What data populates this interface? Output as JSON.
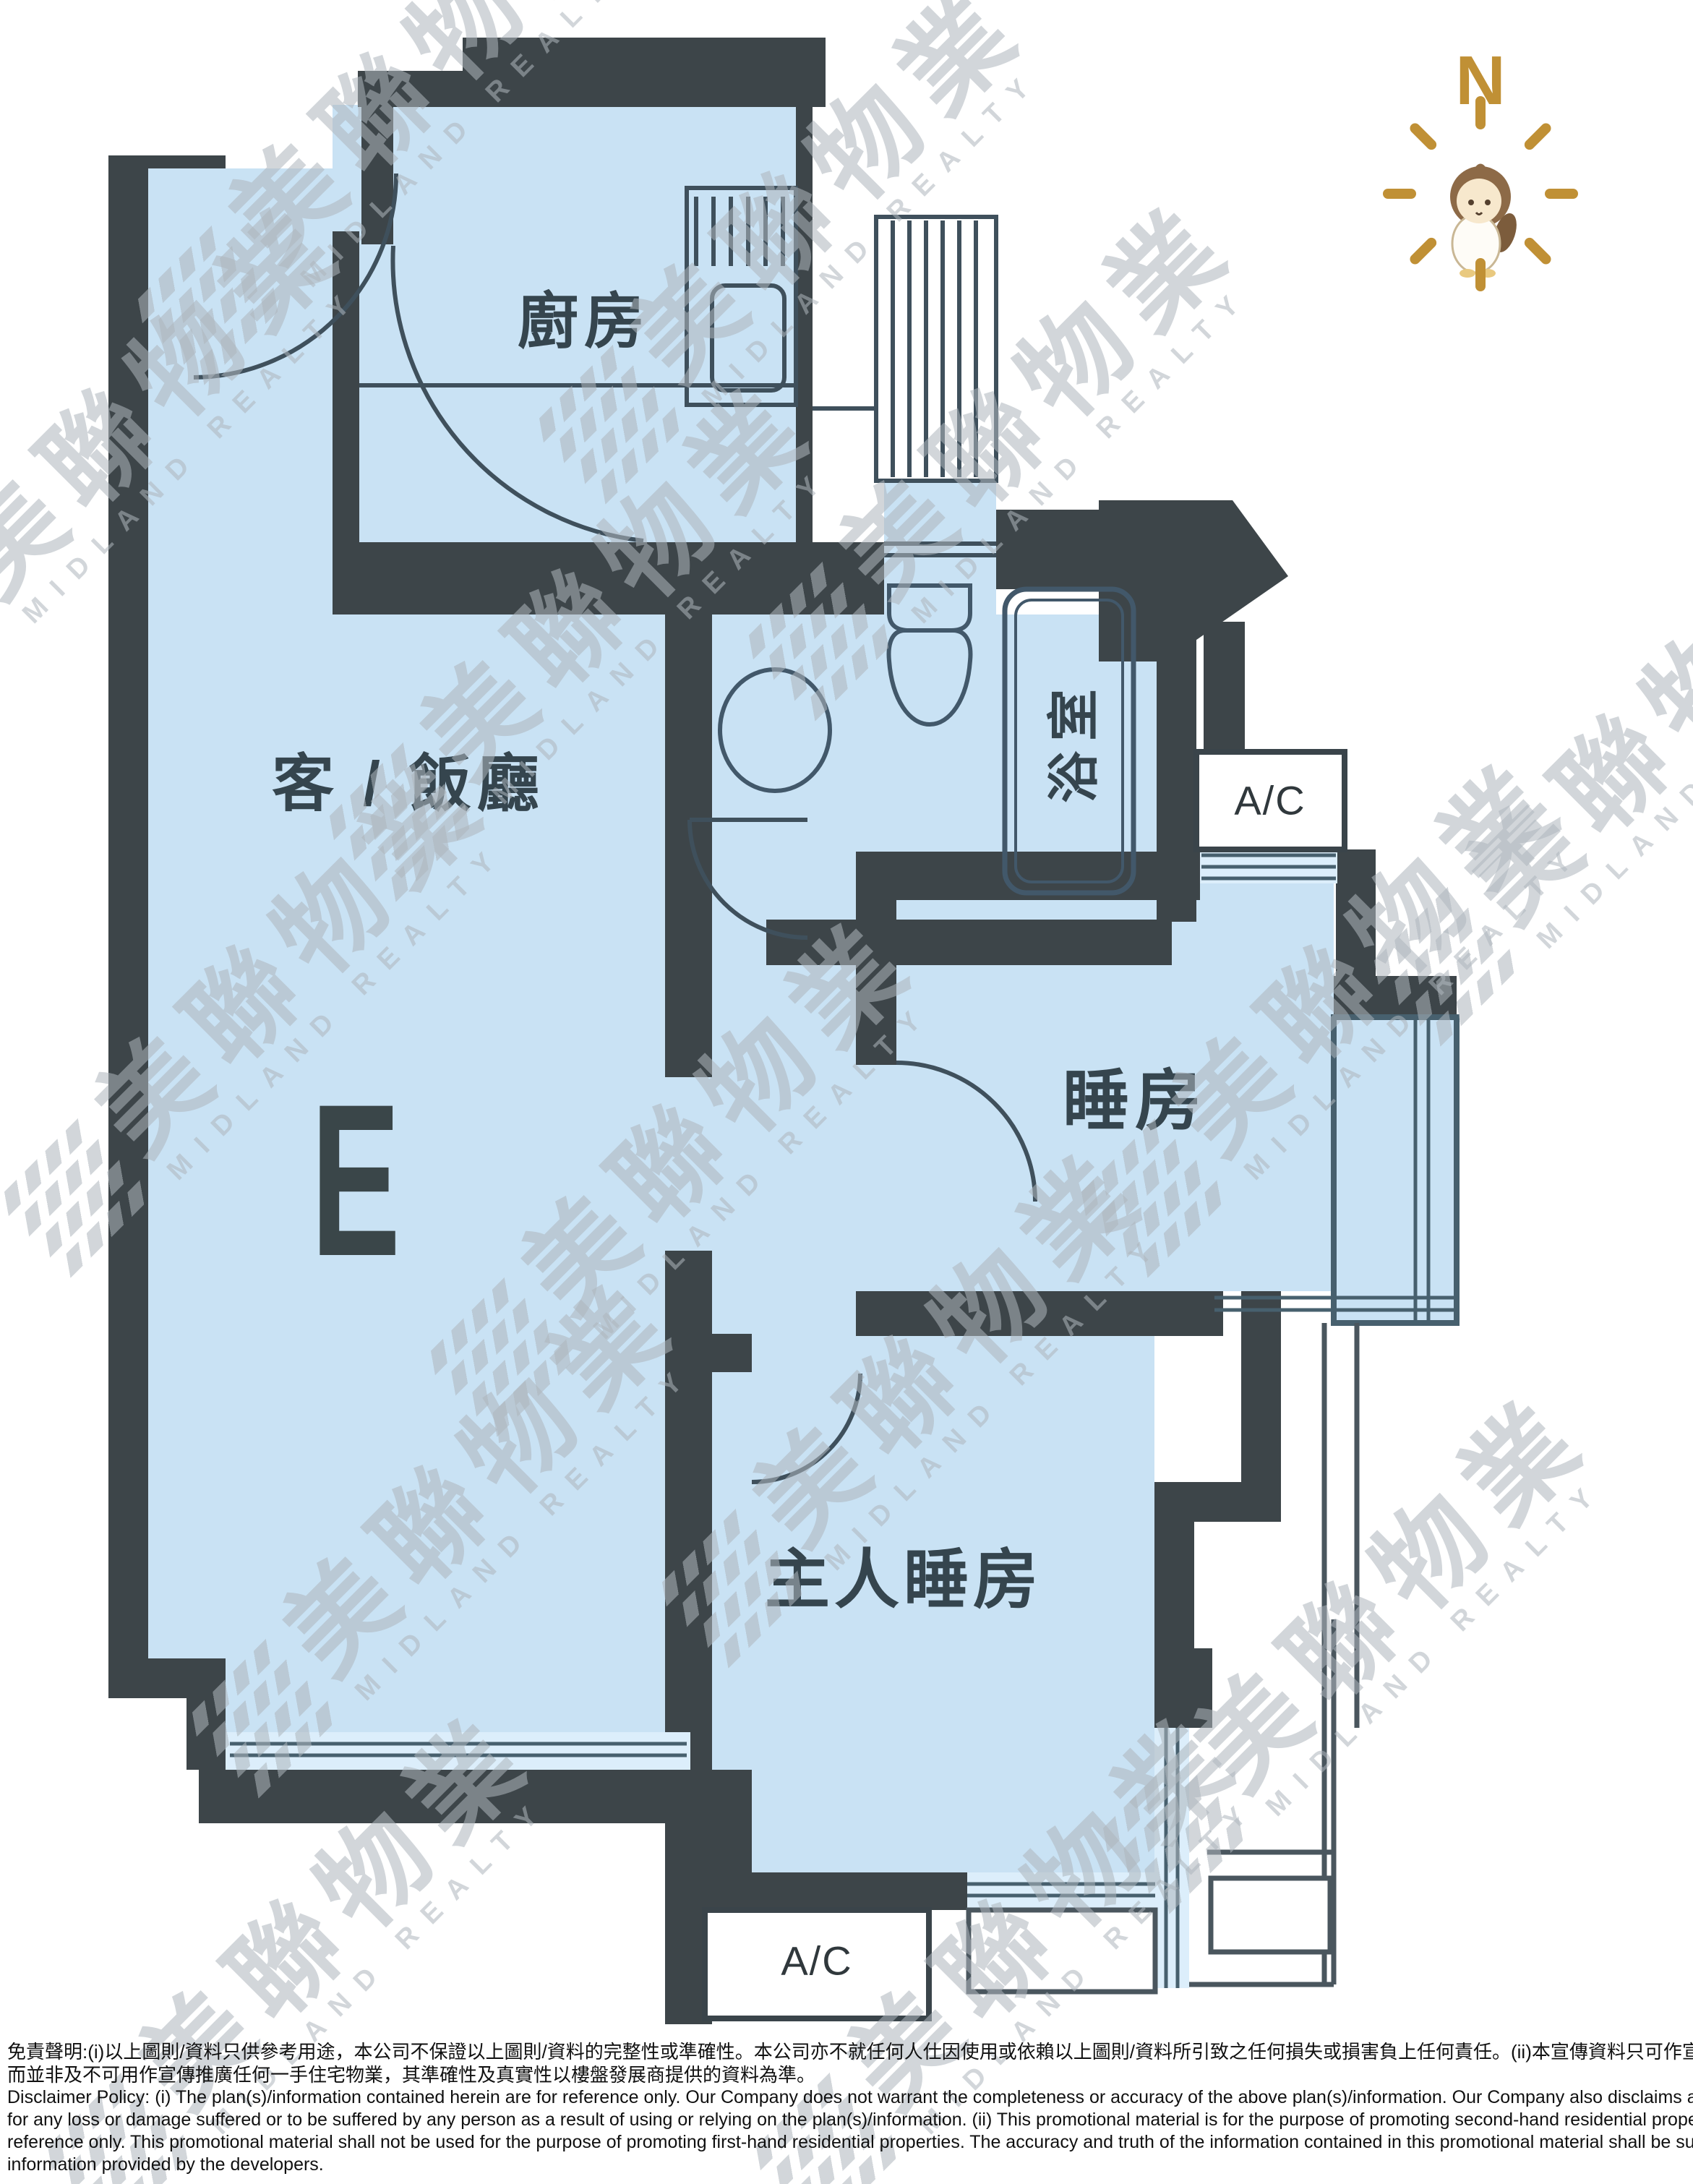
{
  "floor_plan": {
    "unit_label": "E",
    "compass": {
      "north": "N"
    },
    "rooms": [
      {
        "id": "kitchen",
        "label": "廚房"
      },
      {
        "id": "living_dining",
        "label": "客 / 飯廳"
      },
      {
        "id": "bathroom",
        "label": "浴室"
      },
      {
        "id": "bedroom",
        "label": "睡房"
      },
      {
        "id": "master_bedroom",
        "label": "主人睡房"
      }
    ],
    "ac_labels": [
      "A/C",
      "A/C"
    ]
  },
  "watermark": {
    "cjk": "美聯物業",
    "latin": "MIDLAND REALTY"
  },
  "disclaimer": {
    "zh": [
      "免責聲明:(i)以上圖則/資料只供參考用途，本公司不保證以上圖則/資料的完整性或準確性。本公司亦不就任何人仕因使用或依賴以上圖則/資料所引致之任何損失或損害負上任何責任。(ii)本宣傳資料只可作宣傳及推廣二手住宅物業之用及只供參考，",
      "而並非及不可用作宣傳推廣任何一手住宅物業，其準確性及真實性以樓盤發展商提供的資料為準。"
    ],
    "en": [
      "Disclaimer Policy: (i) The plan(s)/information contained herein are for reference only. Our Company does not warrant the completeness or accuracy of the above plan(s)/information. Our Company also disclaims any liability whatsoever",
      "for any loss or damage suffered or to be suffered by any person as a result of using or relying on the plan(s)/information. (ii) This promotional material is for the purpose of promoting second-hand residential properties and for",
      "reference only. This promotional material shall not be used for the purpose of promoting first-hand residential properties. The accuracy and truth of the information contained in this promotional material shall be subject to",
      "information provided by the developers."
    ]
  },
  "colors": {
    "floor": "#c9e2f4",
    "window_fill": "#dceefb",
    "wall": "#3d4549",
    "line": "#3f505c",
    "label": "#35454e",
    "compass_gold": "#c09035",
    "watermark": "#aeb6bd"
  }
}
